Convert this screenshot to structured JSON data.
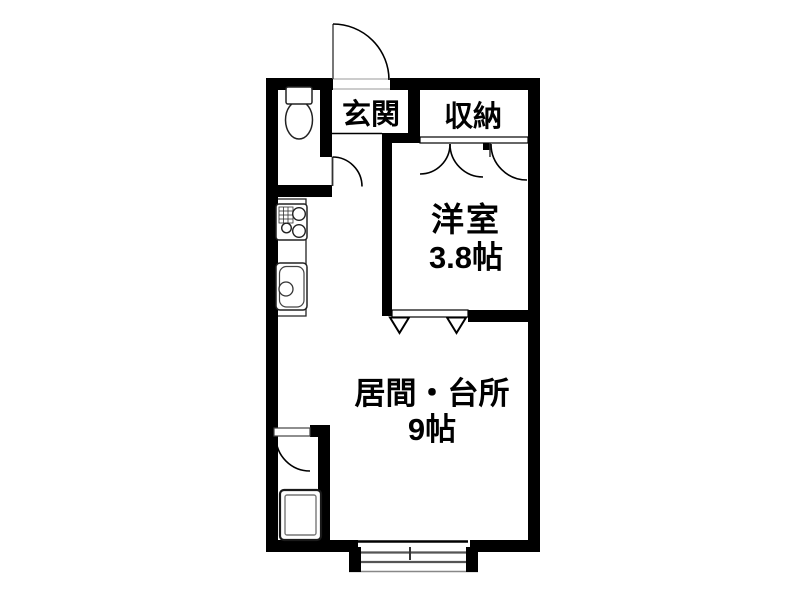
{
  "floorplan": {
    "kind": "japanese-apartment-floor-plan",
    "rooms": [
      {
        "key": "genkan",
        "label": "玄関"
      },
      {
        "key": "closet",
        "label": "収納"
      },
      {
        "key": "western-room",
        "label": "洋室",
        "size": "3.8帖"
      },
      {
        "key": "living-kitchen",
        "label": "居間・台所",
        "size": "9帖"
      }
    ],
    "fixtures": [
      {
        "name": "toilet-icon"
      },
      {
        "name": "gas-stove-icon"
      },
      {
        "name": "kitchen-sink-icon"
      },
      {
        "name": "bathtub-icon"
      }
    ],
    "symbols": [
      {
        "name": "entry-door-swing"
      },
      {
        "name": "toilet-door-swing"
      },
      {
        "name": "closet-double-door-swing"
      },
      {
        "name": "closet-single-door-swing"
      },
      {
        "name": "bathroom-door-swing"
      },
      {
        "name": "folding-door-triangles"
      },
      {
        "name": "sliding-window"
      }
    ],
    "colors": {
      "wall": "#000000",
      "background": "#ffffff",
      "fixture_line": "#222222",
      "window_rail": "#555555"
    }
  }
}
